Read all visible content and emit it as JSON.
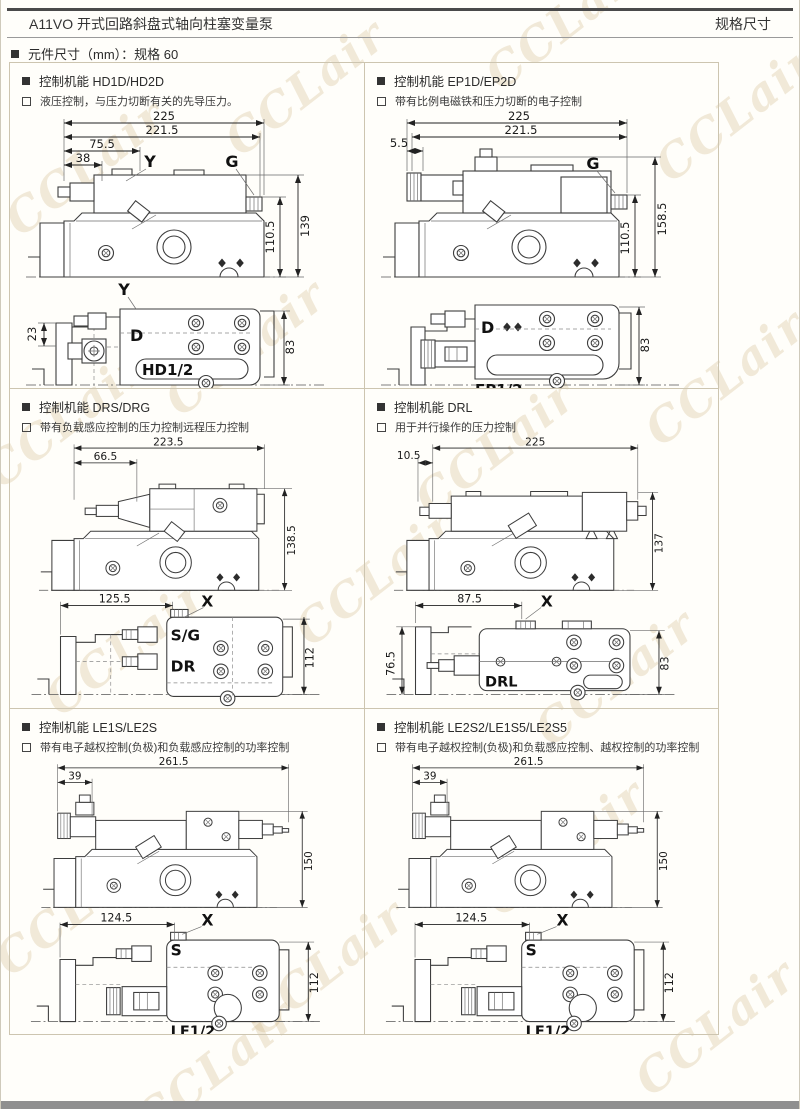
{
  "page": {
    "header_title": "A11VO 开式回路斜盘式轴向柱塞变量泵",
    "header_right": "规格尺寸",
    "section_title": "元件尺寸（mm）：规格 60",
    "watermark": "CCLair"
  },
  "panels": [
    {
      "title": "控制机能 HD1D/HD2D",
      "desc": "液压控制，与压力切断有关的先导压力。",
      "top": {
        "d225": "225",
        "d2215": "221.5",
        "d755": "75.5",
        "d38": "38",
        "pY": "Y",
        "pG": "G",
        "d139": "139",
        "d1105": "110.5"
      },
      "bot": {
        "pY": "Y",
        "d23": "23",
        "pD": "D",
        "model": "HD1/2",
        "d83": "83"
      }
    },
    {
      "title": "控制机能 EP1D/EP2D",
      "desc": "带有比例电磁铁和压力切断的电子控制",
      "top": {
        "d225": "225",
        "d2215": "221.5",
        "d55": "5.5",
        "pG": "G",
        "d1585": "158.5",
        "d1105": "110.5"
      },
      "bot": {
        "pD": "D",
        "model": "EP1/2",
        "d83": "83"
      }
    },
    {
      "title": "控制机能 DRS/DRG",
      "desc": "带有负载感应控制的压力控制远程压力控制",
      "top": {
        "d2235": "223.5",
        "d665": "66.5",
        "d1385": "138.5"
      },
      "bot": {
        "d1255": "125.5",
        "pX": "X",
        "pSG": "S/G",
        "pDR": "DR",
        "d112": "112"
      }
    },
    {
      "title": "控制机能 DRL",
      "desc": "用于并行操作的压力控制",
      "top": {
        "d225": "225",
        "d105": "10.5",
        "d137": "137"
      },
      "bot": {
        "d875": "87.5",
        "pX": "X",
        "d765": "76.5",
        "model": "DRL",
        "d83": "83"
      }
    },
    {
      "title": "控制机能 LE1S/LE2S",
      "desc": "带有电子越权控制(负极)和负载感应控制的功率控制",
      "top": {
        "d2615": "261.5",
        "d39": "39",
        "d150": "150"
      },
      "bot": {
        "d1245": "124.5",
        "pX": "X",
        "pS": "S",
        "d112": "112",
        "model": "LE1/2"
      }
    },
    {
      "title": "控制机能 LE2S2/LE1S5/LE2S5",
      "desc": "带有电子越权控制(负极)和负载感应控制、越权控制的功率控制",
      "top": {
        "d2615": "261.5",
        "d39": "39",
        "d150": "150"
      },
      "bot": {
        "d1245": "124.5",
        "pX": "X",
        "pS": "S",
        "d112": "112",
        "model": "LE1/2"
      }
    }
  ]
}
